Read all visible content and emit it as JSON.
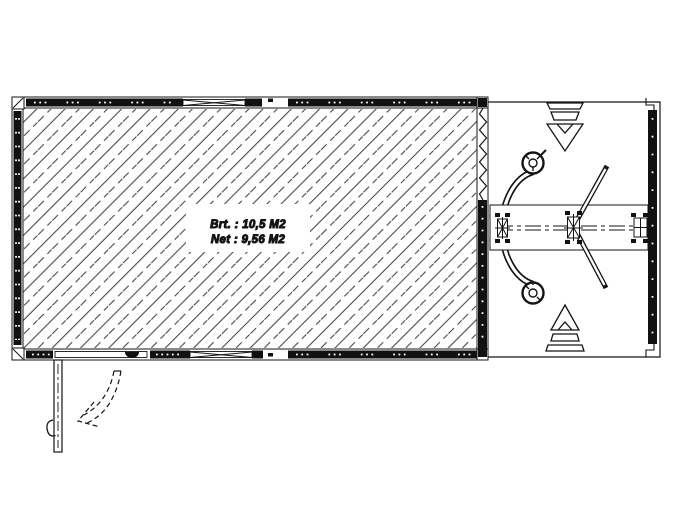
{
  "drawing": {
    "area_label": {
      "gross": "Brt. : 10,5 M2",
      "net": "Net : 9,56 M2"
    },
    "colors": {
      "line": "#141414",
      "wall_fill": "#111111",
      "hatch_line": "#4a4a4a",
      "background": "#ffffff"
    },
    "icons": {
      "direction_arrow_top": "stacked-bars-down-triangle",
      "direction_arrow_bottom": "up-triangle-stacked-bars",
      "hitch_eye": "towing-eye-ring",
      "door_swing": "dashed-curved-arrow",
      "window": "crossed-glazing-lines"
    }
  }
}
